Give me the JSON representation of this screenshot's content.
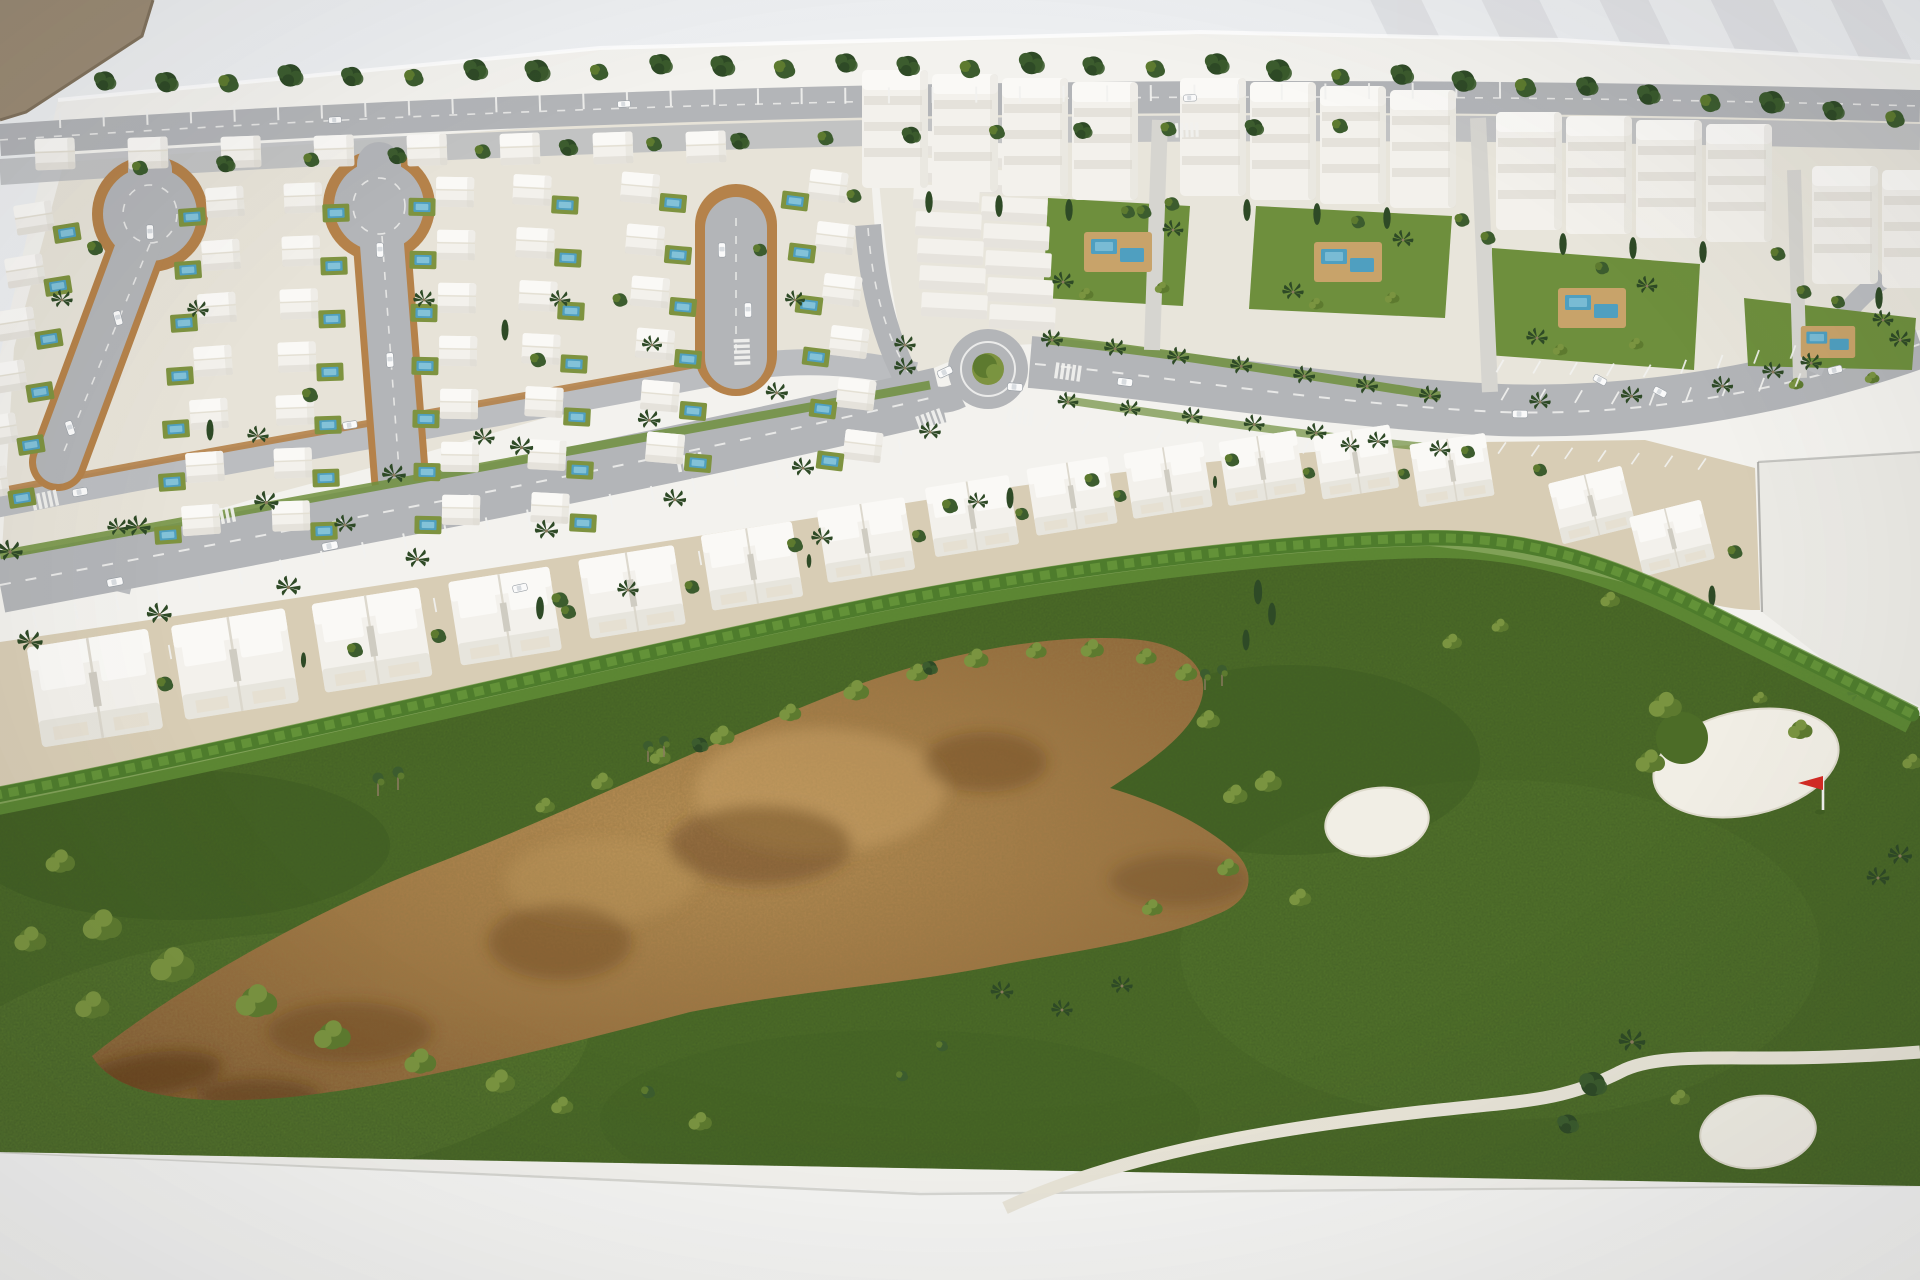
{
  "meta": {
    "domain": "Natural-Image",
    "subject": "Photograph of an architectural scale model (maquette) of a resort residential development beside a golf course, seen from a high oblique angle",
    "setting": "white model board on a table, brown card corner at top-left, striped wall reflection at top-right"
  },
  "palette": {
    "background": "#eef0f2",
    "wall_stripe": "#d9dade",
    "cardboard": "#9c8c75",
    "board_top": "#f3f2ee",
    "board_face": "#f6f6f4",
    "table": "#d9d9db",
    "road": "#b3b5b8",
    "road2": "#bbbdc0",
    "kerb": "#b5824a",
    "lawn": "#7e9340",
    "garden_grass": "#6e8f3d",
    "building_white": "#f3f1ec",
    "building_back": "#faf9f6",
    "building_shade": "#d9d6cd",
    "deck": "#e6e0d2",
    "sand_plot": "#d8cdb5",
    "parcel": "#ebeae5",
    "pool_water": "#4f9fc0",
    "pool_water_light": "#83c2d8",
    "pool_deck": "#c8a36a",
    "hedge": "#4e7c2c",
    "hedge_light": "#639238",
    "golf_turf": "#4c6c27",
    "golf_dark": "#3c5a1f",
    "golf_light": "#5d7e31",
    "waste_mid": "#9a7140",
    "waste_light": "#bb9257",
    "waste_dark": "#7d5730",
    "waste_maroon": "#5a3518",
    "bunker": "#f1eee5",
    "cart_path": "#e9e5d8",
    "flag_red": "#d42a24",
    "car_white": "#fafafa",
    "tree_dark": "#2e4a26",
    "tree_mid": "#3c5c2e",
    "bush": "#5d7a2f",
    "bush_light": "#7a9440",
    "trunk": "#8a7a5e"
  },
  "scene": {
    "features": [
      "villa-district-with-cul-de-sac-loops",
      "tree-lined-boulevard-with-parking",
      "apartment-blocks-with-garden-pools",
      "palm-lined-avenue",
      "roundabout",
      "townhouse-row-on-sand-plots",
      "perimeter-hedge",
      "golf-course-with-waste-area",
      "sand-bunkers",
      "golf-flag",
      "cart-path",
      "empty-white-parcel"
    ],
    "counts": {
      "cul_de_sac_loops": 3,
      "roundabouts": 1,
      "golf_bunkers": 3,
      "golf_flags": 1,
      "apartment_clusters": 4,
      "garden_pool_complexes": 4
    }
  }
}
